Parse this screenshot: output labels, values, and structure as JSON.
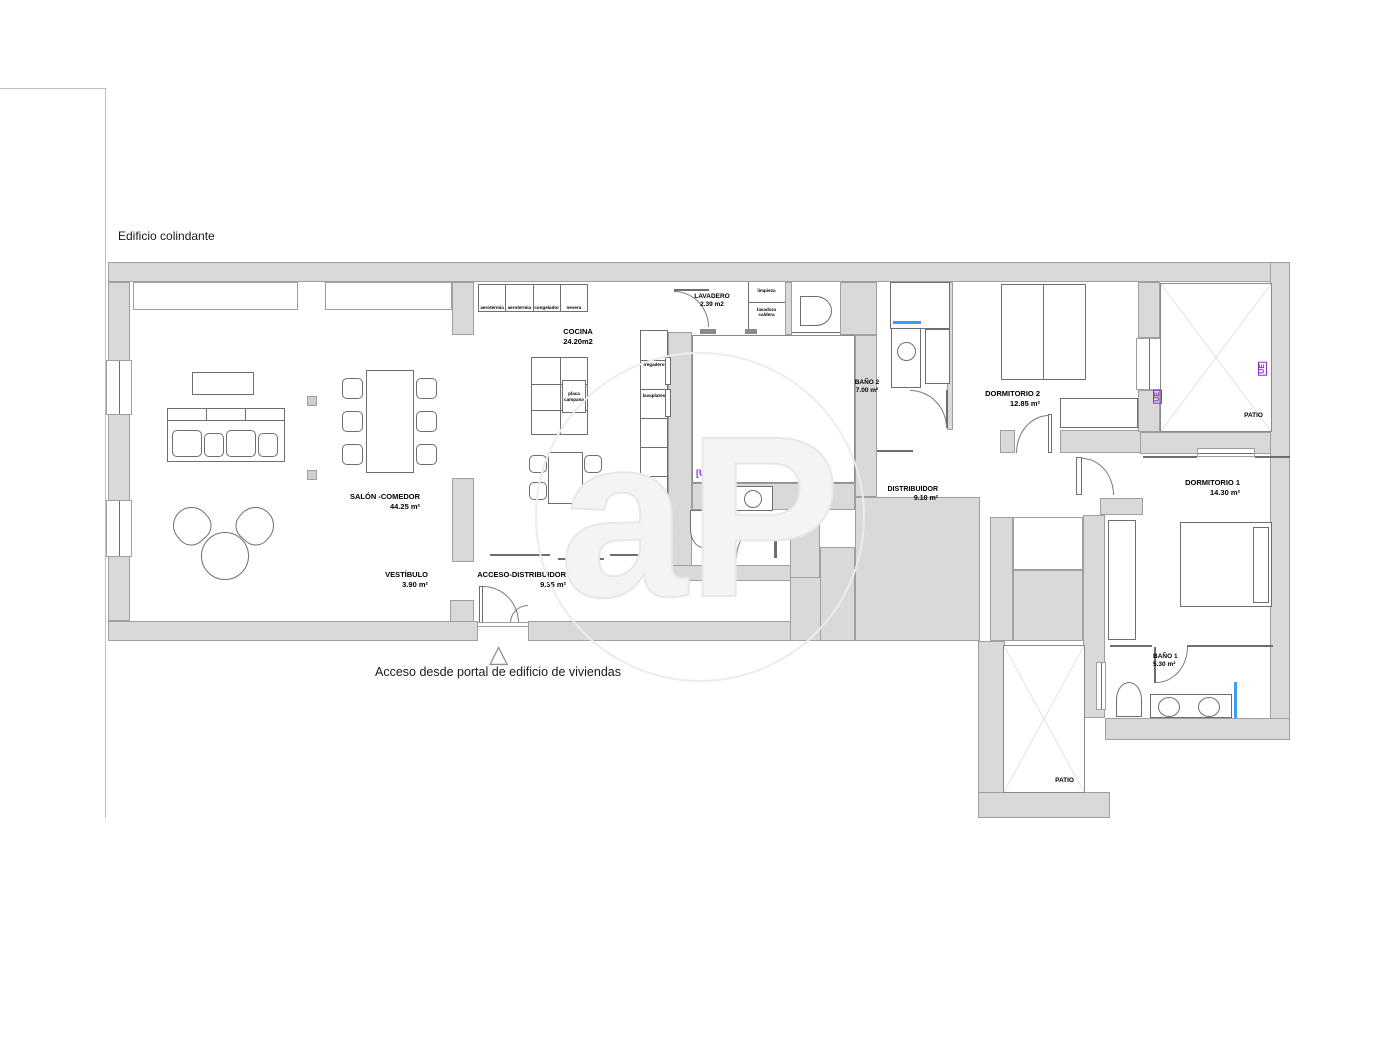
{
  "annotations": {
    "adjacent_building": "Edificio colindante",
    "entrance_caption": "Acceso desde portal de edificio de viviendas"
  },
  "watermark": "aP",
  "ue_tags": {
    "center": "[UE]",
    "patio_left": "UE",
    "patio_right": "UE"
  },
  "rooms": {
    "salon": {
      "name": "SALÓN -COMEDOR",
      "area": "44.25 m²"
    },
    "vestibulo": {
      "name": "VESTÍBULO",
      "area": "3.90 m²"
    },
    "acceso": {
      "name": "ACCESO-DISTRIBUIDOR",
      "area": "9.35 m²"
    },
    "cocina": {
      "name": "COCINA",
      "area": "24.20m2"
    },
    "lavadero": {
      "name": "LAVADERO",
      "area": "2.39 m2"
    },
    "aseo": {
      "name": "ASEO",
      "area": "2.35 m²"
    },
    "bano2": {
      "name": "BAÑO 2",
      "area": "7.00 m²"
    },
    "dormitorio2": {
      "name": "DORMITORIO 2",
      "area": "12.85 m²"
    },
    "distribuidor": {
      "name": "DISTRIBUIDOR",
      "area": "9.10 m²"
    },
    "dormitorio1": {
      "name": "DORMITORIO 1",
      "area": "14.30 m²"
    },
    "bano1": {
      "name": "BAÑO 1",
      "area": "5.30 m²"
    },
    "patio_top_right": {
      "name": "PATIO"
    },
    "patio_center": {
      "name": "PATIO"
    },
    "patio_bottom": {
      "name": "PATIO"
    }
  },
  "fixtures": {
    "kitchen_wall_units": [
      "aerotermia",
      "aerotermia",
      "congelador",
      "nevera"
    ],
    "island_hob": [
      "placa",
      "campana"
    ],
    "tall_unit_sink": "fregadero",
    "tall_unit_dishwasher": "lavaplatos",
    "oven_stack": [
      "forn",
      "horno",
      "micro"
    ],
    "laundry_top": "limpieza",
    "laundry_bottom": [
      "lavadora",
      "caldera"
    ]
  },
  "colors": {
    "wall_fill": "#d9d9d9",
    "wall_line": "#9f9f9f",
    "detail_line": "#6e6e6e",
    "accent_blue": "#3d9bff",
    "accent_purple": "#8b2fd6",
    "watermark_line": "#e7e7e7"
  }
}
